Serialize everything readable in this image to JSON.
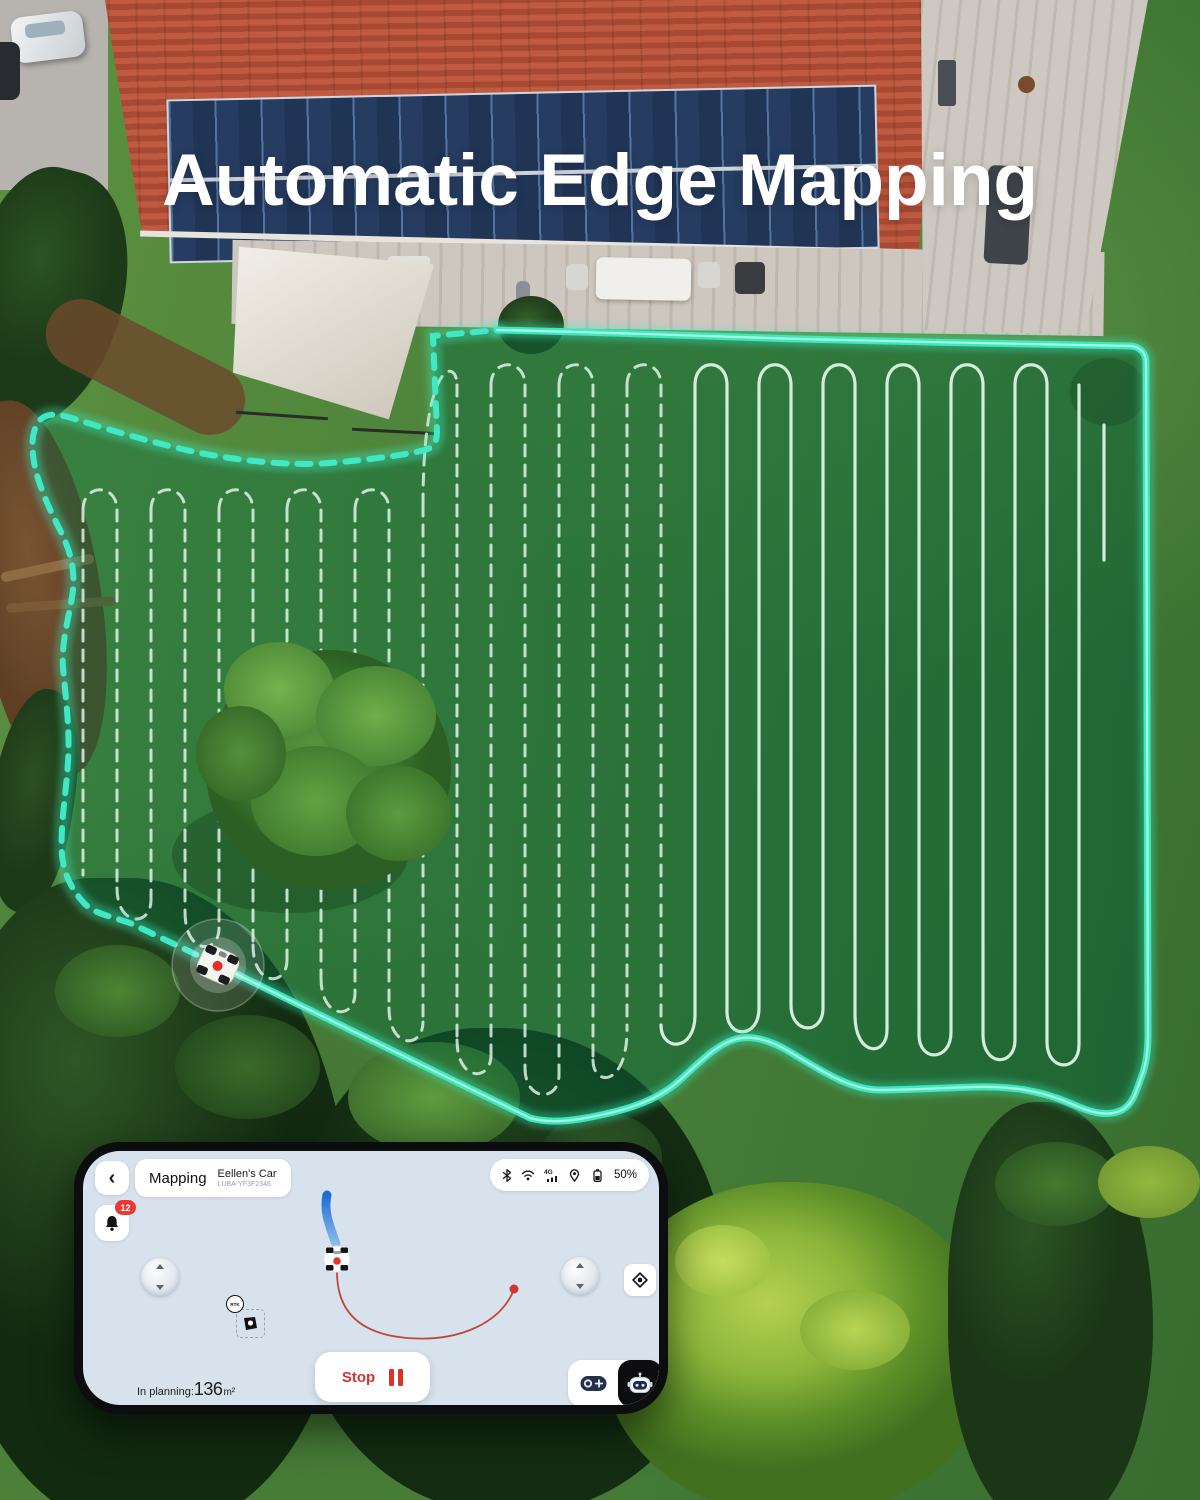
{
  "title": {
    "text": "Automatic Edge Mapping"
  },
  "phone": {
    "header": {
      "back_icon": "‹",
      "page_label": "Mapping",
      "device_name": "Eellen's Car",
      "device_id": "LUBA-YF3F2346"
    },
    "status_bar": {
      "battery_percent": "50%"
    },
    "notifications": {
      "badge_count": "12"
    },
    "map": {
      "rtk_badge": "RTK"
    },
    "controls": {
      "planning_label": "In planning:",
      "planning_value": "136",
      "planning_unit": "m²",
      "stop_label": "Stop"
    }
  },
  "colors": {
    "edge_border_teal": "#3ce9bf",
    "zone_fill_green": "rgba(10,105,60,0.45)",
    "mow_line_white": "#e6f6ec",
    "accent_red": "#e0342e",
    "trace_blue": "#2273d6",
    "trace_red": "#c4483c",
    "screen_bg": "#d8e2ed"
  }
}
